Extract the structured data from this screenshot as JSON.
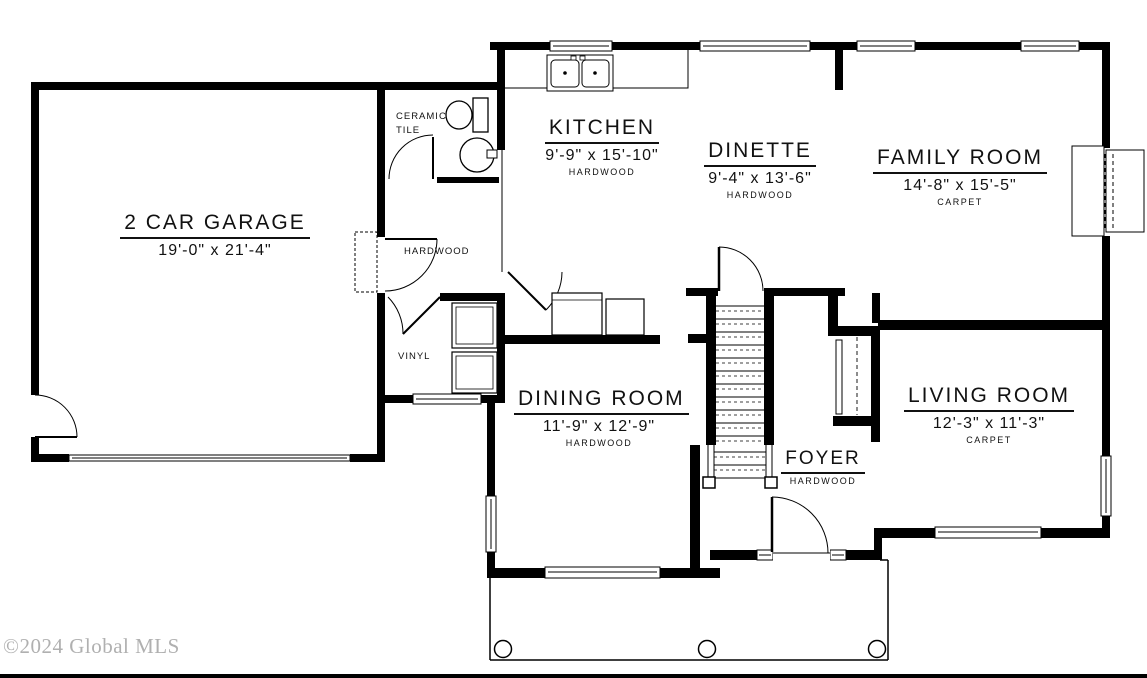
{
  "watermark": "©2024 Global MLS",
  "colors": {
    "wall": "#000000",
    "background": "#ffffff",
    "watermark": "#b0b0b0"
  },
  "rooms": {
    "garage": {
      "name": "2 CAR GARAGE",
      "dims": "19'-0\" x 21'-4\""
    },
    "kitchen": {
      "name": "KITCHEN",
      "dims": "9'-9\" x 15'-10\"",
      "floor": "HARDWOOD"
    },
    "dinette": {
      "name": "DINETTE",
      "dims": "9'-4\" x 13'-6\"",
      "floor": "HARDWOOD"
    },
    "family_room": {
      "name": "FAMILY ROOM",
      "dims": "14'-8\" x 15'-5\"",
      "floor": "CARPET"
    },
    "dining_room": {
      "name": "DINING ROOM",
      "dims": "11'-9\" x 12'-9\"",
      "floor": "HARDWOOD"
    },
    "living_room": {
      "name": "LIVING ROOM",
      "dims": "12'-3\" x 11'-3\"",
      "floor": "CARPET"
    },
    "foyer": {
      "name": "FOYER",
      "floor": "HARDWOOD"
    }
  },
  "surface_labels": {
    "ceramic_line1": "CERAMIC",
    "ceramic_line2": "TILE",
    "hall": "HARDWOOD",
    "mud": "VINYL"
  }
}
